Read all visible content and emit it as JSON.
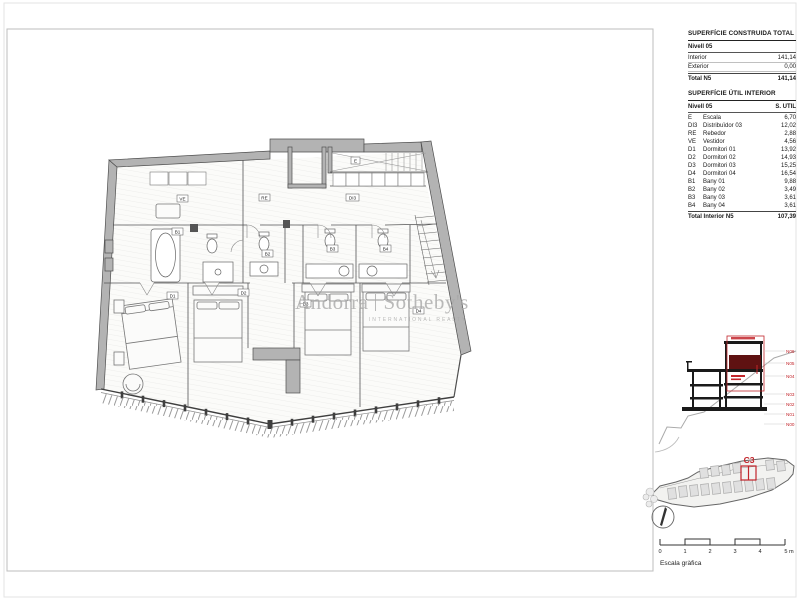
{
  "colors": {
    "accent_red": "#c2252b",
    "section_highlight_fill": "#5f1212",
    "wall_gray": "#b3b3b3",
    "watermark_gray": "#a9a9a9"
  },
  "watermark": {
    "brand_left": "Andorra",
    "brand_right": "Sotheby's",
    "subtitle": "INTERNATIONAL REALTY"
  },
  "tables": {
    "constructed": {
      "title": "SUPERFÍCIE CONSTRUIDA TOTAL",
      "section": "Nivell 05",
      "rows": [
        {
          "label": "Interior",
          "value": "141,14"
        },
        {
          "label": "Exterior",
          "value": "0,00"
        }
      ],
      "total": {
        "label": "Total N5",
        "value": "141,14"
      }
    },
    "usable": {
      "title": "SUPERFÍCIE ÚTIL INTERIOR",
      "header": {
        "col1": "Nivell 05",
        "col2": "S. UTIL"
      },
      "rows": [
        {
          "code": "E",
          "name": "Escala",
          "value": "6,70"
        },
        {
          "code": "DI3",
          "name": "Distribuïdor 03",
          "value": "12,02"
        },
        {
          "code": "RE",
          "name": "Rebedor",
          "value": "2,88"
        },
        {
          "code": "VE",
          "name": "Vestidor",
          "value": "4,56"
        },
        {
          "code": "D1",
          "name": "Dormitori 01",
          "value": "13,92"
        },
        {
          "code": "D2",
          "name": "Dormitori 02",
          "value": "14,93"
        },
        {
          "code": "D3",
          "name": "Dormitori 03",
          "value": "15,25"
        },
        {
          "code": "D4",
          "name": "Dormitori 04",
          "value": "16,54"
        },
        {
          "code": "B1",
          "name": "Bany 01",
          "value": "9,88"
        },
        {
          "code": "B2",
          "name": "Bany 02",
          "value": "3,49"
        },
        {
          "code": "B3",
          "name": "Bany 03",
          "value": "3,61"
        },
        {
          "code": "B4",
          "name": "Bany 04",
          "value": "3,61"
        }
      ],
      "total": {
        "label": "Total Interior N5",
        "value": "107,39"
      }
    }
  },
  "plan": {
    "labels": [
      {
        "text": "E"
      },
      {
        "text": "RE"
      },
      {
        "text": "DI3"
      },
      {
        "text": "VE"
      },
      {
        "text": "B1"
      },
      {
        "text": "B2"
      },
      {
        "text": "B3"
      },
      {
        "text": "B4"
      },
      {
        "text": "D1"
      },
      {
        "text": "D2"
      },
      {
        "text": "D3"
      },
      {
        "text": "D4"
      }
    ]
  },
  "section": {
    "levels": [
      "N06",
      "N05",
      "N04",
      "N03",
      "N02",
      "N01",
      "N00"
    ]
  },
  "site": {
    "unit_label": "C3"
  },
  "scale": {
    "ticks": [
      "0",
      "1",
      "2",
      "3",
      "4",
      "5 m"
    ],
    "caption": "Escala gràfica"
  }
}
